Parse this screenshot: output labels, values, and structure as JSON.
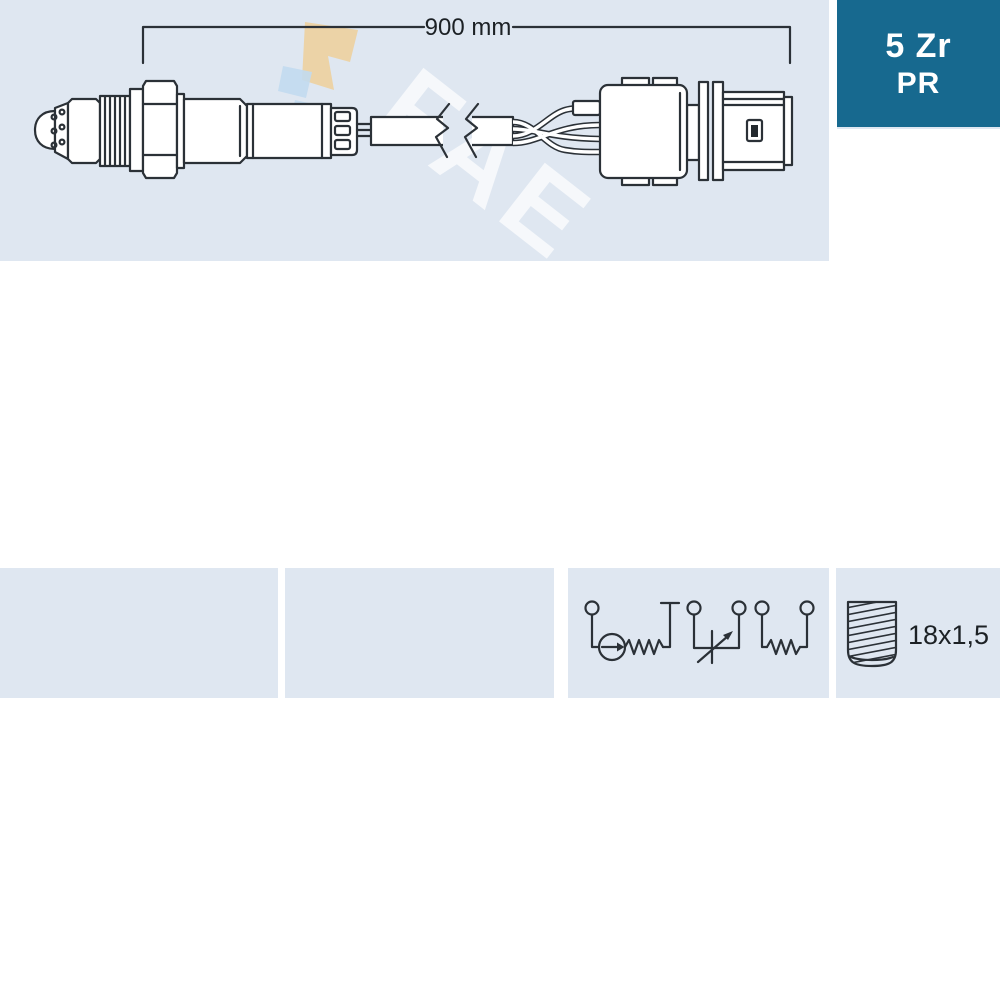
{
  "page": {
    "type": "auto-part-technical-diagram",
    "product": "lambda-oxygen-sensor"
  },
  "colors": {
    "background": "#ffffff",
    "panel_bg": "#dfe7f1",
    "accent_panel_bg": "#17698f",
    "line": "#2b3137",
    "text_dark": "#1c2125",
    "text_on_accent": "#ffffff",
    "logo_beige": "#ecd2a2",
    "logo_blue": "#c2daf0"
  },
  "main_diagram": {
    "dimension_label": "900 mm",
    "drawing": "oxygen-sensor-with-cable-break-and-connector"
  },
  "pinout_panel": {
    "icon": "connector-pinout-icon",
    "pin_count_vertical": 4,
    "pin_count_flat": 2
  },
  "code_panel": {
    "line1": "5 Zr",
    "line2": "PR"
  },
  "circuit_panel": {
    "icon": "wiring-circuit-icon",
    "terminals": 5,
    "symbols": [
      "current-source-with-resistor",
      "variable-resistor",
      "resistor"
    ]
  },
  "thread_panel": {
    "icon": "thread-bolt-icon",
    "label": "18x1,5"
  },
  "watermark": {
    "text": "FAE"
  }
}
